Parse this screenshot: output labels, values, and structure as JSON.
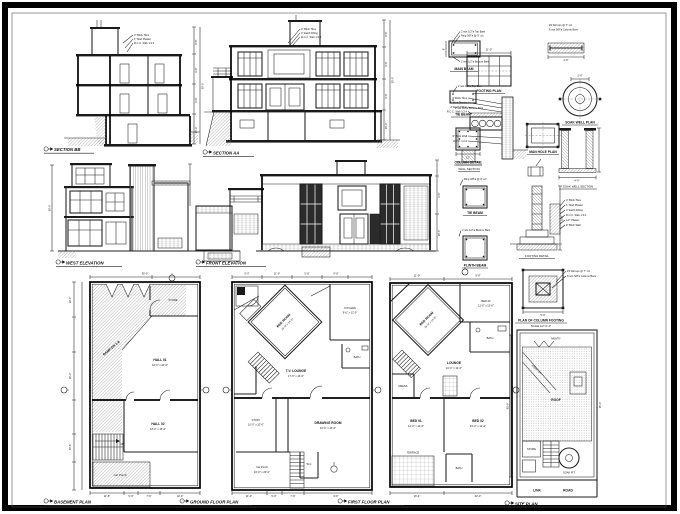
{
  "sheet": {
    "background": "#ffffff",
    "frame_color": "#000000",
    "line_color": "#1c1c1c",
    "window_dark": "#2b2b2b"
  },
  "titles": {
    "section_bb": "SECTION BB",
    "section_aa": "SECTION AA",
    "west_elevation": "WEST ELEVATION",
    "front_elevation": "FRONT ELEVATION",
    "basement_plan": "BASEMENT PLAN",
    "ground_floor_plan": "GROUND FLOOR PLAN",
    "first_floor_plan": "FIRST FLOOR PLAN",
    "site_plan": "SITE PLAN"
  },
  "details": {
    "main_beam": "MAIN BEAM",
    "tie_beam": "TIE BEAM",
    "plinth_beam": "PLINTH BEAM",
    "column_detail": "COLUMN DETAIL",
    "footing_plan": "FOOTING PLAN",
    "man_hole_plan": "MAN HOLE PLAN",
    "wall_section": "WALL SECTION",
    "footing_detail": "FOOTING DETAIL",
    "soak_well_plan": "SOAK WELL PLAN",
    "soak_well_section": "SOAK WELL SECTION",
    "column_footing_line1": "PLAN OF COLUMN FOOTING",
    "column_footing_line2": "SCALE 1/2\"=1'-0\""
  },
  "notes": {
    "beam_top": "2 nos 1/2\"ø Top Bars",
    "beam_ring": "Ring 3/8\"ø @ 9\" c/c",
    "beam_bottom": "2 nos 1/2\"ø Bottom Bars",
    "col_stirrups": "#3 Stirrups @ 7\" c/c",
    "col_bars": "8 nos 5/8\"ø Column Bars",
    "layers": [
      "4\" Brick Tiles",
      "1\" Mud Plaster",
      "4\" Earth Filling",
      "R.C.C. Slab 1:2:4",
      "1/2\" Plaster",
      "9\" Brick Wall"
    ],
    "pcc": "1:4:8 P.C.C.",
    "dpc": "D.P.C. 1:2:4"
  },
  "basement": {
    "ramp": "RAMP DN 1:8",
    "store": "STORE",
    "hall1": "HALL 01",
    "hall1_size": "18'-0\" x 24'-0\"",
    "hall2": "HALL 02",
    "hall2_size": "18'-0\" x 15'-6\"",
    "up": "UP",
    "porch": "Car Porch"
  },
  "ground": {
    "bed": "BED ROOM",
    "bed_size": "16'-0\" x 14'-0\"",
    "kitchen": "KITCHEN",
    "kitchen_size": "9'-6\" x 12'-0\"",
    "bath": "BATH",
    "lounge": "T.V. LOUNGE",
    "lounge_size": "17'-6\" x 16'-0\"",
    "study": "STUDY",
    "study_size": "10'-0\" x 12'-0\"",
    "drawing": "DRAWING ROOM",
    "drawing_size": "16'-0\" x 13'-6\"",
    "wc": "W.C",
    "porch": "Car Porch",
    "porch_size": "16'-0\" x 20'-0\""
  },
  "first": {
    "bed": "BED ROOM",
    "bed_size": "15'-0\" x 14'-0\"",
    "bed3": "BED 03",
    "bed3_size": "11'-0\" x 12'-0\"",
    "bath": "BATH",
    "lounge": "LOUNGE",
    "lounge_size": "16'-0\" x 12'-6\"",
    "dress": "DRESS",
    "bed1": "BED 01",
    "bed1_size": "14'-0\" x 12'-6\"",
    "bed2": "BED 02",
    "bed2_size": "16'-0\" x 12'-6\"",
    "terrace": "TERRACE"
  },
  "site": {
    "mumty": "MUMTY",
    "ramp": "RAMP DN",
    "roof": "ROOF",
    "store": "STORE",
    "soak_pit": "SOAK PIT",
    "road_1": "LINK",
    "road_2": "ROAD"
  },
  "dims": {
    "b_width": "35'-0\"",
    "b1": "11'-6\"",
    "b2": "5'-0\"",
    "b3": "7'-6\"",
    "b4": "12'-0\"",
    "g1": "11'-0\"",
    "g2": "5'-0\"",
    "g3": "7'-6\"",
    "g4": "9'-6\"",
    "gt1": "9'-0\"",
    "gt2": "11'-0\"",
    "gt3": "5'-6\"",
    "gt4": "9'-6\"",
    "f1": "16'-4\"",
    "f2": "22'-0\"",
    "l1": "10'-0\"",
    "l2": "16'-0\"",
    "l3": "15'-6\"",
    "h1": "8'-6\"",
    "h2": "9'-6\"",
    "h3": "10'-0\"",
    "total_h": "30'-0\"",
    "beam_w": "9\"",
    "col_w": "12\"",
    "footing_w": "11'-0\"",
    "cf": "5'-6\"",
    "well_d": "4'-6\"",
    "well_i": "2'-6\"",
    "site_depth": "65'-0\"",
    "site_width": "35'-0\""
  }
}
